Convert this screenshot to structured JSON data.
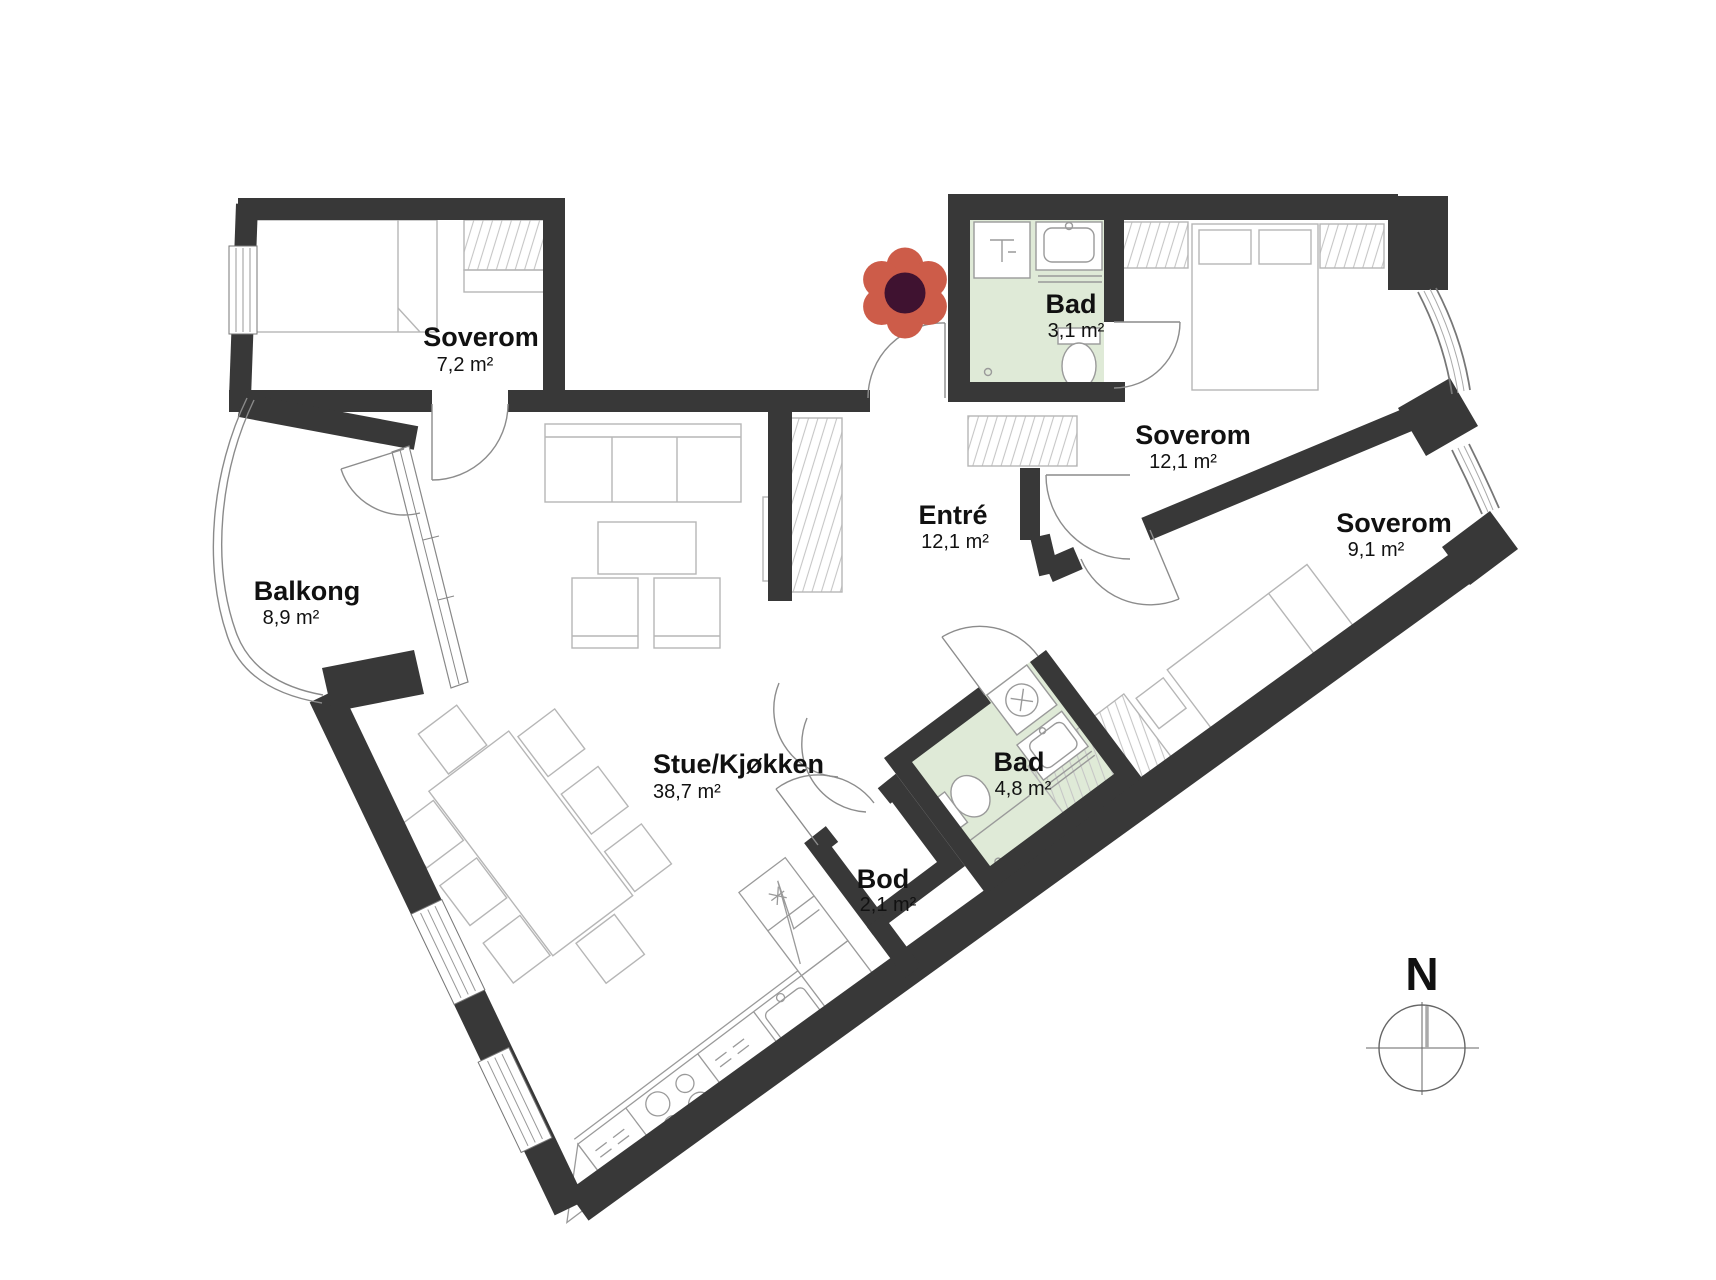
{
  "plan": {
    "rooms": {
      "soverom_nw": {
        "name": "Soverom",
        "area": "7,2 m²"
      },
      "balkong": {
        "name": "Balkong",
        "area": "8,9 m²"
      },
      "stue_kjokken": {
        "name": "Stue/Kjøkken",
        "area": "38,7 m²"
      },
      "entre": {
        "name": "Entré",
        "area": "12,1 m²"
      },
      "bad_nord": {
        "name": "Bad",
        "area": "3,1 m²"
      },
      "soverom_ost": {
        "name": "Soverom",
        "area": "12,1 m²"
      },
      "soverom_sor": {
        "name": "Soverom",
        "area": "9,1 m²"
      },
      "bad_sor": {
        "name": "Bad",
        "area": "4,8 m²"
      },
      "bod": {
        "name": "Bod",
        "area": "2,1 m²"
      }
    },
    "compass": {
      "label": "N"
    },
    "colors": {
      "wall": "#383838",
      "bath_floor": "#dfead7",
      "flower_petal": "#cd5c49",
      "flower_center": "#3f1230",
      "furniture": "#b6b6b6",
      "fixture": "#9a9a9a",
      "door": "#8c8c8c",
      "label": "#111111"
    }
  }
}
